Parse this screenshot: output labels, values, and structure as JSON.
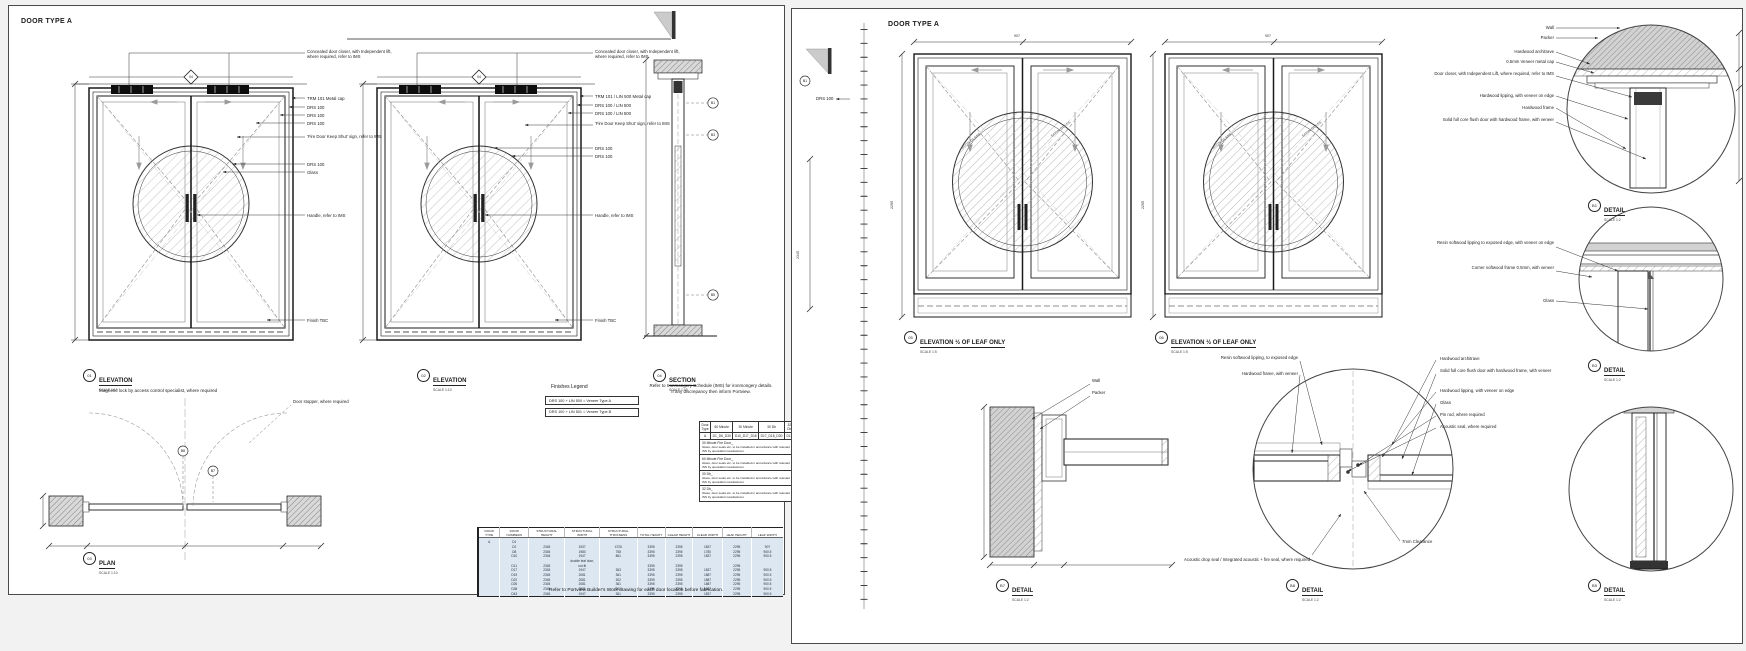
{
  "colors": {
    "line": "#1a1a1a",
    "hatch": "#9f9f9f",
    "wall_fill": "#d9d9d9",
    "table_blue": "#dce7f1",
    "sheet_bg": "#ffffff"
  },
  "left": {
    "title": "DOOR TYPE A",
    "elev1": {
      "ref": "01",
      "title": "ELEVATION",
      "scale": "SCALE 1:10",
      "section_marker": "04",
      "labels": [
        "Concealed door closer, with Independent lift, where required, refer to IMS",
        "TRM 101 Metal cap",
        "DRS 100",
        "DRS 100",
        "DRS 100",
        "'Fire Door Keep Shut' sign, refer to IMS",
        "DRS 100",
        "Glass",
        "Handle, refer to IMS",
        "Finish TBC"
      ],
      "note": "Magnetic lock by access control specialist, where required"
    },
    "elev2": {
      "ref": "02",
      "title": "ELEVATION",
      "scale": "SCALE 1:10",
      "section_marker": "04",
      "labels": [
        "Concealed door closer, with Independent lift, where required, refer to IMS",
        "TRM 101 / LIN 500 Metal cap",
        "DRS 100 / LIN 500",
        "DRS 100 / LIN 500",
        "'Fire Door Keep Shut' sign, refer to IMS",
        "DRS 100",
        "DRS 100",
        "Handle, refer to IMS",
        "Finish TBC"
      ]
    },
    "section": {
      "ref": "04",
      "title": "SECTION",
      "scale": "SCALE 1:10",
      "detail_refs": [
        "B1",
        "B3",
        "B5"
      ]
    },
    "plan": {
      "ref": "03",
      "title": "PLAN",
      "scale": "SCALE 1:10",
      "stopper_label": "Door stopper, where required",
      "detail_refs": [
        "B8",
        "B7"
      ]
    },
    "finishes": {
      "title": "Finishes Legend",
      "rows": [
        "DRS 100 + LIN 500 = Veneer Type A",
        "DRS 100 + LIN 501 = Veneer Type B"
      ]
    },
    "ironmongery_note": [
      "Refer to Ironmongery Schedule (IMS) for ironmongery details.",
      "If any discrepancy then inform Portview."
    ],
    "fire_table": {
      "headers": [
        "Door Type",
        "60 Minute",
        "30 Minute",
        "30 Db",
        "32 Db"
      ],
      "row": [
        "A",
        "D1_D6_D30",
        "D10_D17_D18",
        "D17_D18_D30",
        "D11"
      ],
      "notes": [
        {
          "head": "30 Minute Fire Door_",
          "body": "Glass, door seals etc. to be installed in accordance with relevant ISS by specialist manufacturer."
        },
        {
          "head": "60 Minute Fire Door_",
          "body": "Glass, door seals etc. to be installed in accordance with relevant ISS by specialist manufacturer."
        },
        {
          "head": "30 Db_",
          "body": "Glass, door seals etc. to be installed in accordance with relevant ISS by specialist manufacturer."
        },
        {
          "head": "32 Db_",
          "body": "Glass, door seals etc. to be installed in accordance with relevant ISS by specialist manufacturer."
        }
      ]
    },
    "schedule": {
      "headers": [
        "DOOR TYPE",
        "DOOR NUMBERS",
        "STRUCTURAL HEIGHT",
        "STRUCTURAL WIDTH",
        "STRUCTURAL THICKNESS",
        "TOTAL HEIGHT",
        "CLEAR HEIGHT",
        "CLEAR WIDTH",
        "LEAF HEIGHT",
        "LEAF WIDTH"
      ],
      "rows": [
        [
          "A",
          "D1",
          "",
          "",
          "",
          "",
          "",
          "",
          "",
          ""
        ],
        [
          "",
          "D2",
          "2345",
          "1937",
          "4726",
          "3395",
          "2395",
          "1837",
          "2295",
          "907"
        ],
        [
          "",
          "D8",
          "2345",
          "1980",
          "758",
          "3395",
          "2395",
          "1780",
          "2295",
          "900.5"
        ],
        [
          "",
          "D10",
          "2345",
          "1947",
          "861",
          "3395",
          "2395",
          "1837",
          "2295",
          "900.5"
        ],
        [
          "",
          "",
          "",
          "double leaf door,",
          "",
          "",
          "",
          "",
          "",
          ""
        ],
        [
          "",
          "D11",
          "2345",
          "not fit",
          "",
          "3395",
          "2395",
          "",
          "2295",
          ""
        ],
        [
          "",
          "D17",
          "2345",
          "1947",
          "363",
          "3395",
          "2395",
          "1837",
          "2295",
          "900.5"
        ],
        [
          "",
          "D19",
          "2345",
          "2081",
          "361",
          "3395",
          "2395",
          "1887",
          "2295",
          "900.5"
        ],
        [
          "",
          "D22",
          "2345",
          "2081",
          "302",
          "3395",
          "2395",
          "1887",
          "2295",
          "900.5"
        ],
        [
          "",
          "D26",
          "2345",
          "2081",
          "361",
          "3395",
          "2395",
          "1887",
          "2295",
          "900.5"
        ],
        [
          "",
          "D38",
          "2345",
          "2081",
          "361",
          "3395",
          "2395",
          "1887",
          "2295",
          "900.5"
        ],
        [
          "",
          "D43",
          "2345",
          "1947",
          "361",
          "3395",
          "2395",
          "1837",
          "2295",
          "900.5"
        ]
      ]
    },
    "footer_note": "Refer to Portview Builder's Work drawing for each door location before fabrication."
  },
  "right": {
    "title": "DOOR TYPE A",
    "fragment": {
      "ref": "B1",
      "label": "DRS 100",
      "dim": "2345"
    },
    "elev1": {
      "ref": "05",
      "title": "ELEVATION ½ OF LEAF ONLY",
      "scale": "SCALE 1:5",
      "glass_label": "SATIN GLASS",
      "dim_w": "907",
      "dim_h": "2295"
    },
    "elev2": {
      "ref": "06",
      "title": "ELEVATION ½ OF LEAF ONLY",
      "scale": "SCALE 1:5",
      "glass_label": "SATIN GLASS",
      "dim_w": "907",
      "dim_h": "2295"
    },
    "details": [
      {
        "ref": "B1",
        "title": "DETAIL",
        "scale": "SCALE 1:2",
        "labels": [
          "Wall",
          "Packer",
          "Hardwood architrave",
          "0.5mm Veneer metal cap",
          "Door closer, with Independent Lift, where required, refer to IMS",
          "Hardwood lipping, with veneer on edge",
          "Hardwood frame",
          "Solid full core flush door with hardwood frame, with veneer"
        ]
      },
      {
        "ref": "B3",
        "title": "DETAIL",
        "scale": "SCALE 1:2",
        "labels": [
          "Resin softwood lipping to exposed edge, with veneer on edge",
          "Corner softwood frame 0.5mm, with veneer",
          "Glass"
        ]
      },
      {
        "ref": "B5",
        "title": "DETAIL",
        "scale": "SCALE 1:2",
        "labels": []
      },
      {
        "ref": "B7",
        "title": "DETAIL",
        "scale": "SCALE 1:2",
        "labels": [
          "Wall",
          "Packer"
        ]
      },
      {
        "ref": "B8",
        "title": "DETAIL",
        "scale": "SCALE 1:2",
        "labels": [
          "Hardwood architrave",
          "Solid full core flush door with hardwood frame, with veneer",
          "Hardwood lipping, with veneer on edge",
          "Glass",
          "Pin rod, where required",
          "Acoustic seal, where required",
          "Resin softwood lipping, to exposed edge",
          "Hardwood frame, with veneer",
          "Acoustic drop seal / Integrated acoustic + fire seal, where required",
          "7mm Clearance"
        ]
      }
    ]
  }
}
